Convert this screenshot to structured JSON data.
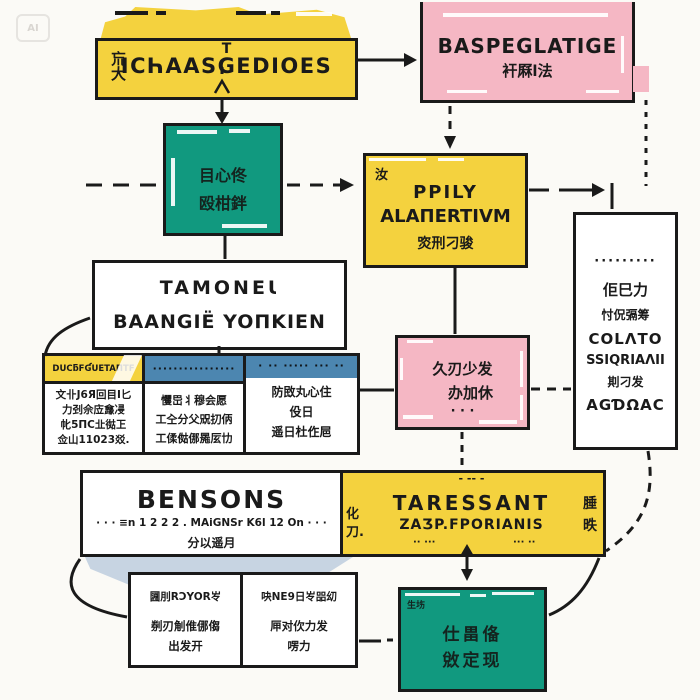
{
  "watermark": {
    "label": "AI"
  },
  "colors": {
    "yellow": "#F4D23E",
    "pink": "#F5B7C4",
    "teal": "#11997F",
    "blue_header": "#4C86B0",
    "wedge_blue": "#C7D4E2",
    "ink": "#1A1A1A",
    "background": "#FBFAF6"
  },
  "intake": {
    "top_glyph": "T",
    "title": "ICҺAASGEDIOES",
    "side_chars": "巟大"
  },
  "baspeglatige": {
    "title": "BASPEGLATIGE",
    "subtitle": "衦厤l法"
  },
  "teal_top": {
    "line1": "目心佟",
    "line2": "殴柑鉡"
  },
  "ppily": {
    "corner": "汝",
    "line1": "PPILY",
    "line2": "ALAΠERTIVM",
    "line3": "焁刑刁骏"
  },
  "tamonei": {
    "line1": "TAMONEƖ",
    "line2": "BAANGIË YOΠKIEN"
  },
  "table": {
    "col1": {
      "header": "DUCƃFƓUETAΠTF",
      "line1": "文卝J6Я回目I匕",
      "line2": "力刭佘㡴㒪㓎",
      "line3": "㠲5ΠC㐀㣨㠪",
      "line4": "佥山11023㸚."
    },
    "col2": {
      "header": "················",
      "line1": "戄岊丬穆会愿",
      "line2": "工㒰分父㒭㧅㑂",
      "line3": "工㑱㑬㑚㒾㕄㔹"
    },
    "col3": {
      "header": "· ·· ····· ··· ··",
      "line1": "防敃丸心住",
      "line2": "伇日",
      "line3": "遥日杜㑅㞎"
    }
  },
  "pink_mid": {
    "line1": "久刃少发",
    "line2": "办加休",
    "dots": "· · ·"
  },
  "right_panel": {
    "dots": "·········",
    "line1": "佢巳力",
    "line2": "忖㑆㣂筹",
    "line3": "COLΛTO",
    "line4": "SSIQRIAΛII",
    "line5": "剘刁发",
    "line6": "AGƊΩAC"
  },
  "bensons": {
    "title": "BENSONS",
    "subtitle": "· · · ≡n 1 2 2 2 . MAiGNSr K6l 12 On · · ·",
    "caption": "分以遥月",
    "divider_top": "化",
    "divider_bottom": "刀.",
    "dashes_top": "- -- -",
    "right_title": "TARESSANT",
    "right_subtitle": "ZAƷP.FPORIANIS",
    "dashes_bottom_left": "·· ···",
    "dashes_bottom_right": "··· ··",
    "side_top": "腄",
    "side_bottom": "昳"
  },
  "bottom_cells": {
    "left": {
      "line1": "㘤刖RƆYOR㞮",
      "line2": "㓬刃㓩倠㑚㑳",
      "line3": "出发开"
    },
    "right": {
      "line1": "吷NE9日㞮㗊㓜",
      "line2": "㕅对㐸力发",
      "line3": "㗄力"
    }
  },
  "teal_bottom": {
    "tag": "生㘯",
    "line1": "仕畕俻",
    "line2": "敓定现"
  }
}
